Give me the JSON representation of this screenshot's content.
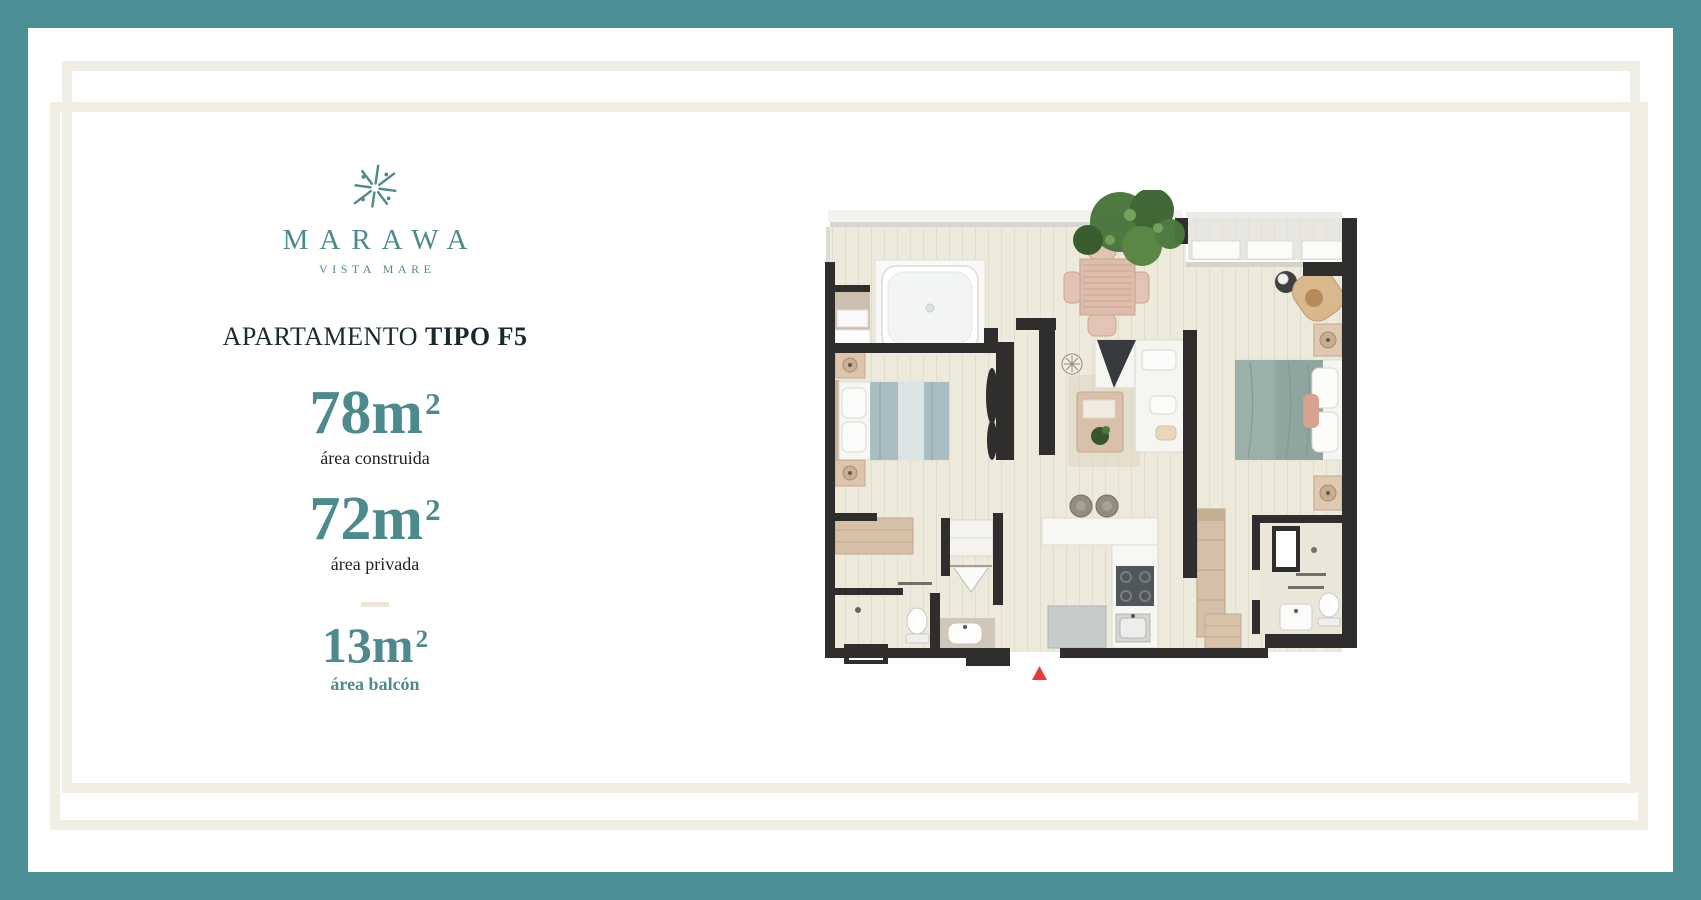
{
  "brand": {
    "name": "MARAWA",
    "tagline": "VISTA MARE"
  },
  "title": {
    "regular": "APARTAMENTO",
    "bold": "TIPO F5"
  },
  "areas": [
    {
      "value": "78m",
      "exponent": "2",
      "label": "área construida"
    },
    {
      "value": "72m",
      "exponent": "2",
      "label": "área privada"
    },
    {
      "value": "13m",
      "exponent": "2",
      "label": "área balcón"
    }
  ],
  "floorplan": {
    "entrance_marker": "red-triangle",
    "rooms": [
      "balcony-jacuzzi",
      "dining-area",
      "balcony-terrace",
      "bedroom-1",
      "living-room",
      "master-bedroom",
      "closet",
      "bathroom-1",
      "kitchen",
      "bathroom-2"
    ]
  },
  "colors": {
    "teal": "#4B9094",
    "teal_text": "#4D8A8D",
    "frame": "#F1EEE3",
    "ink": "#1A2930",
    "label_ink": "#222222",
    "accent_red": "#E83A3E",
    "wall": "#2F2E2C",
    "floor": "#EDEADC"
  }
}
